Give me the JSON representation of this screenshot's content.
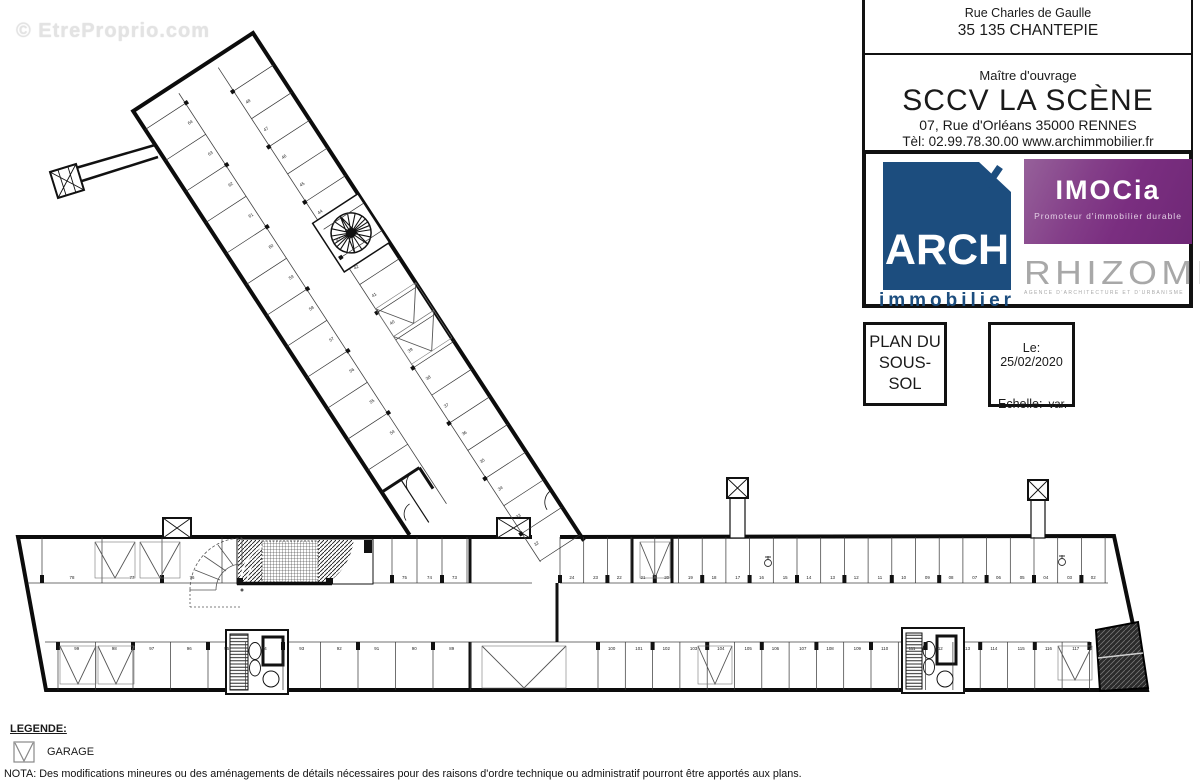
{
  "watermark": "© EtreProprio.com",
  "title_block": {
    "address_line1": "Rue Charles de Gaulle",
    "address_line2": "35 135 CHANTEPIE",
    "owner_label": "Maître d'ouvrage",
    "owner_name": "SCCV LA SCÈNE",
    "owner_address": "07, Rue d'Orléans 35000 RENNES",
    "owner_contact": "Tèl: 02.99.78.30.00 www.archimmobilier.fr",
    "logo_arch": {
      "name": "ARCH",
      "sub": "immobilier",
      "color": "#1c4d7e"
    },
    "logo_imocia": {
      "name": "IMOCia",
      "tagline": "Promoteur d'immobilier durable",
      "color": "#7a2e80"
    },
    "logo_rhizome": {
      "name": "RHIZOME",
      "tagline": "AGENCE D'ARCHITECTURE ET D'URBANISME",
      "color": "#a8a8a8"
    },
    "plan_title_line1": "PLAN DU",
    "plan_title_line2": "SOUS-SOL",
    "date_label": "Le: 25/02/2020",
    "scale_label": "Echelle:",
    "scale_value": "var."
  },
  "legend": {
    "title": "LEGENDE:",
    "garage_label": "GARAGE"
  },
  "nota": "NOTA: Des modifications mineures ou des aménagements de détails nécessaires pour des raisons d'ordre technique ou administratif pourront être apportés aux plans.",
  "plan": {
    "rows": [
      {
        "id": "top-left-garages",
        "x_start": 42,
        "pitch": 60,
        "y0": 537,
        "y1": 583,
        "ly": 579,
        "labels": [
          "78",
          "77",
          "76"
        ],
        "ticks": true
      },
      {
        "id": "top-left-stalls",
        "x_start": 392,
        "pitch": 25,
        "y0": 537,
        "y1": 583,
        "ly": 579,
        "labels": [
          "75",
          "74",
          "73"
        ],
        "ticks": true
      },
      {
        "id": "top-right",
        "x_start": 560,
        "pitch": 23.7,
        "y0": 537,
        "y1": 583,
        "ly": 579,
        "labels": [
          "24",
          "23",
          "22",
          "21",
          "20",
          "19",
          "18",
          "17",
          "16",
          "15",
          "14",
          "13",
          "12",
          "11",
          "10",
          "09",
          "08",
          "07",
          "06",
          "05",
          "04",
          "03",
          "02"
        ],
        "ticks": true
      },
      {
        "id": "bottom-left",
        "x_start": 58,
        "pitch": 37.5,
        "y0": 642,
        "y1": 690,
        "ly": 650,
        "labels": [
          "99",
          "98",
          "97",
          "96",
          "95",
          "94",
          "93",
          "92",
          "91",
          "90",
          "89"
        ],
        "ticks": true
      },
      {
        "id": "bottom-right",
        "x_start": 598,
        "pitch": 27.3,
        "y0": 642,
        "y1": 690,
        "ly": 650,
        "labels": [
          "100",
          "101",
          "102",
          "103",
          "104",
          "105",
          "106",
          "107",
          "108",
          "109",
          "110",
          "111",
          "112",
          "113",
          "114",
          "115",
          "116",
          "117"
        ],
        "ticks": true
      }
    ],
    "wing": {
      "angle": -33.1,
      "ox": 253,
      "oy": 33,
      "left_stalls": {
        "x0": -143,
        "x1": -95,
        "v_start": 22,
        "pitch": 37,
        "labels": [
          "64",
          "63",
          "62",
          "61",
          "60",
          "59",
          "58",
          "57",
          "56",
          "55",
          "54"
        ]
      },
      "right_stalls": {
        "x0": -48,
        "x1": 0,
        "v_start": 38,
        "pitch": 33,
        "labels": [
          "48",
          "47",
          "46",
          "45",
          "44",
          "43",
          "42",
          "41",
          "40",
          "39",
          "38",
          "37",
          "36",
          "35",
          "34",
          "33",
          "32"
        ]
      }
    },
    "garage_marks": [
      {
        "x": 95,
        "y": 542,
        "w": 40,
        "h": 36
      },
      {
        "x": 140,
        "y": 542,
        "w": 40,
        "h": 36
      },
      {
        "x": 60,
        "y": 646,
        "w": 36,
        "h": 38
      },
      {
        "x": 98,
        "y": 646,
        "w": 36,
        "h": 38
      },
      {
        "x": 482,
        "y": 646,
        "w": 84,
        "h": 42
      },
      {
        "x": 640,
        "y": 542,
        "w": 30,
        "h": 36
      },
      {
        "x": 698,
        "y": 646,
        "w": 34,
        "h": 38
      },
      {
        "x": 1058,
        "y": 646,
        "w": 34,
        "h": 34
      }
    ],
    "wing_garage_marks": [
      {
        "x": -48,
        "y": 298,
        "w": 48,
        "h": 33
      },
      {
        "x": -48,
        "y": 331,
        "w": 48,
        "h": 33
      }
    ]
  }
}
